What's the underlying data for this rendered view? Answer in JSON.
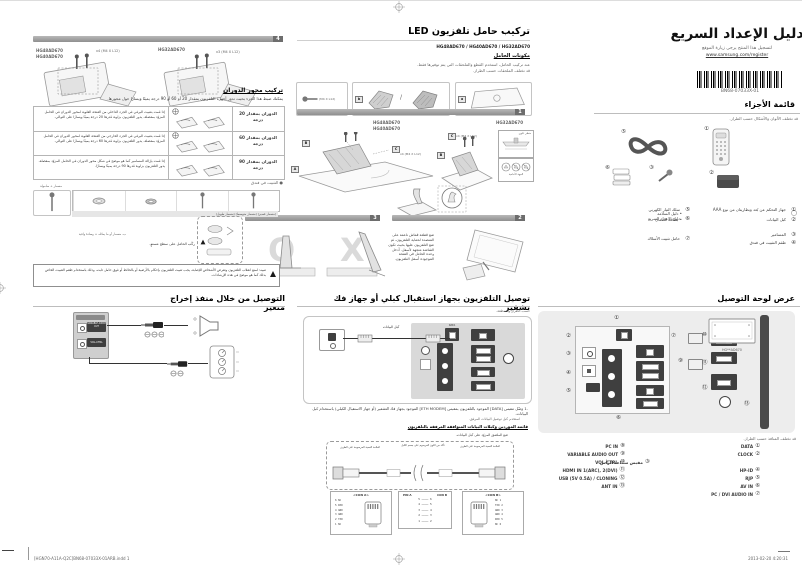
{
  "footer": {
    "file_info": "[HGN70-A11A-Q2C]BN68-07033X-01ARB.indd   1",
    "datetime": "2013-02-20   4:20:31"
  },
  "masthead": {
    "title": "دليل الإعداد السريع",
    "register_note": "لتسجيل هذا المنتج يرجى زيارة الموقع",
    "register_url": "www.samsung.com/register",
    "barcode_text": "BN68-07033X-01"
  },
  "parts": {
    "heading": "قائمة الأجزاء",
    "note": "قد تختلف الألوان والأشكال حسب الطراز.",
    "a": [
      {
        "num": "①",
        "label": "جهاز التحكم عن بُعد وبطاريتان من نوع AAA"
      },
      {
        "num": "②",
        "label": "كبل البيانات"
      },
      {
        "num": "③",
        "label": "المسامير"
      },
      {
        "num": "④",
        "label": "طقم التثبيت في فندق"
      }
    ],
    "b1": {
      "num": "⑤",
      "label": "سلك التيار الكهربي"
    },
    "b2": {
      "num": "⑥",
      "l1": "دليل الإعداد السريع",
      "l2": "دليل السلامة",
      "l3": "بطاقة الضمان"
    },
    "b3": {
      "num": "⑦",
      "label": "حامل تثبيت الأسلاك"
    }
  },
  "stand": {
    "heading": "تركيب حامل تلفزيون LED",
    "models": "HG48AD670 / HG40AD670 / HG32AD670",
    "subheading": "مكونات الحامل",
    "note1": "عند تركيب الحامل، استخدم القطع والملحقات التي يتم توفيرها فقط.",
    "note2": "قد تختلف الملحقات حسب الطراز.",
    "comp_tag_a": "a",
    "comp_tag_b": "b",
    "comp_screw": "(M4 X L12)",
    "step1": "1",
    "step2": "2",
    "step3": "3",
    "models_a1": "HG48AD670",
    "models_a2": "HG40AD670",
    "model_b": "HG32AD670",
    "screws_a": "x4 (M4 X L12)",
    "screws_b": "x4 (M4 X L12)",
    "callout_a": "A",
    "callout_b": "B",
    "callout_c": "C",
    "inset1_caption": "منظر علوي",
    "inset2_caption": "الجهة الأمامية",
    "screwbox_caption": "مسمار + صامولة",
    "screwrow_caption": "(مسمار قصير)  (مسمار متوسط)  (مسمار طويل)",
    "flat_note": "ركّب الحامل على سطح مستوٍ.",
    "flat_note2": "ب- مسمار أو ما يماثله + وسادة واقية",
    "place_text": "ضع قطعة قماش ناعمة على المنضدة لحماية التلفزيون، ثم ضع التلفزيون عليها بحيث تكون الشاشة متجهة لأسفل. أدخل وحدة الحامل في الفتحة الموجودة أسفل التلفزيون.",
    "caution": "تنبيه: لمنع انقلاب التلفزيون وتعرض الأشخاص للإصابة، يجب تثبيت التلفزيون بإحكام بالأرضية أو بالحائط أو فوق حامل ثابت، وذلك باستخدام طقم التثبيت الخاص بذلك كما هو موضح في هذه الإرشادات."
  },
  "swivel": {
    "step4": "4",
    "models_a1": "HG48AD670",
    "models_a2": "HG40AD670",
    "screws_a": "x4 (M4 X L12)",
    "model_b": "HG32AD670",
    "screws_b": "x3 (M4 X L12)",
    "heading": "تركيب محور الدوران",
    "intro": "يمكنك ضبط هذا الجزء بحيث تدور أجهزة التلفزيون بمقدار 20 أو 60 أو 90 درجة يمينًا ويسارًا حول محورها.",
    "rows": [
      {
        "label": "الدوران بمقدار 20 درجة",
        "desc": "إذا قمت بتثبيت البرغي في الجزء الداخلي من الفتحة العلوية لمحور الدوران في الحامل المزوّد بمفصلة، يدور التلفزيون بزاوية قدرها 20 درجة يمينًا ويسارًا على التوالي."
      },
      {
        "label": "الدوران بمقدار 60 درجة",
        "desc": "إذا قمت بتثبيت البرغي في الجزء الخارجي من الفتحة العلوية لمحور الدوران في الحامل المزوّد بمفصلة، يدور التلفزيون بزاوية قدرها 60 درجة يمينًا ويسارًا على التوالي."
      },
      {
        "label": "الدوران بمقدار 90 درجة",
        "desc": "إذا قمت بإزالة المسامير كما هو موضح في شكل محور الدوران في الحامل المزوّد بمفصلة، يدور التلفزيون بزاوية قدرها 90 درجة يمينًا ويسارًا."
      }
    ],
    "fixing_note": "● التثبيت في فندق"
  },
  "panel": {
    "heading": "عرض لوحة التوصيل",
    "tv_model": "HG**AD670",
    "note": "قد تختلف المنافذ حسب الطراز.",
    "ports_a": [
      {
        "num": "①",
        "label": "DATA"
      },
      {
        "num": "②",
        "label": "CLOCK"
      },
      {
        "num": "③",
        "label": "مقبس سماعة الرأس"
      },
      {
        "num": "④",
        "label": "HP-ID"
      },
      {
        "num": "⑤",
        "label": "RJP"
      },
      {
        "num": "⑥",
        "label": "AV IN"
      },
      {
        "num": "⑦",
        "label": "PC / DVI AUDIO IN"
      }
    ],
    "ports_b": [
      {
        "num": "⑧",
        "label": "PC IN"
      },
      {
        "num": "⑨",
        "label": "VARIABLE AUDIO OUT"
      },
      {
        "num": "⑩",
        "label": "VOL-CTRL"
      },
      {
        "num": "⑪",
        "label": "HDMI IN 1(ARC), 2(DVI)"
      },
      {
        "num": "⑫",
        "label": "USB (5V 0.5A) / CLONING"
      },
      {
        "num": "⑬",
        "label": "ANT IN"
      }
    ]
  },
  "stb": {
    "heading": "توصيل التلفزيون بجهاز استقبال كبلي أو جهاز فك تشفير",
    "note": "حسب الطراز والمنطقة.",
    "cable_label": "كبل البيانات",
    "data_port_label": "DATA",
    "step1_num": "1.",
    "step1": "وصّل مقبس [DATA] الموجود بالتلفزيون بمقبس [ETH MODEM] الموجود بجهاز فك التشفير (أو جهاز الاستقبال الكبلي) باستخدام كبل البيانات.",
    "step1b": "استخدم كبل توصيل البيانات المرفق.",
    "vendors_heading": "قائمة الموردين وكبلات البيانات المتوافقة المرفقة بالتلفزيون",
    "sticker_note": "ضع الملصق المزوّد على كبل البيانات.",
    "tag_right": "العلامة النصية المرسومة على الطرف",
    "tag_mid": "تأكد من اللون المرسوم على جسم الكبل",
    "tag_left": "العلامة النصية المرسومة على الطرف",
    "con_a": "<CON A>",
    "con_b": "<CON B>",
    "map_head_a": "PIN A",
    "map_head_b": "CON B",
    "pins_a": [
      "6  NC",
      "5  RXD",
      "4  GND",
      "3  GND",
      "2  TXD",
      "1  NC"
    ],
    "pins_b": [
      "NC  1",
      "TXD  2",
      "GND  3",
      "GND  4",
      "RXD  5",
      "NC  6"
    ],
    "map_rows": [
      "5 ──── 6",
      "4 ──── 5",
      "3 ──── 4",
      "2 ──── 3",
      "1 ──── 2"
    ]
  },
  "varout": {
    "heading": "التوصيل من خلال منفذ إخراج متغير",
    "port1": "VARIABLE AUDIO OUT",
    "port2": "VOL-CTRL"
  }
}
